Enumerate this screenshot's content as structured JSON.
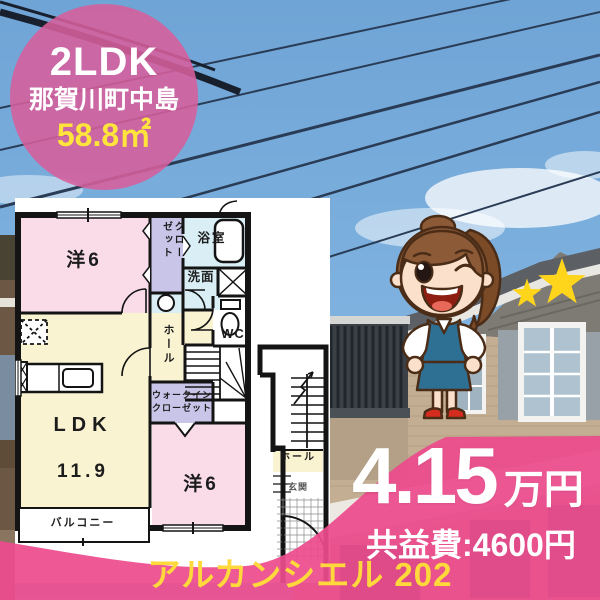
{
  "badge": {
    "layout_type": "2LDK",
    "location": "那賀川町中島",
    "area": "58.8㎡",
    "bg_color": "#D75F9C",
    "area_color": "#FFE53B"
  },
  "price": {
    "amount": "4.15",
    "unit": "万円",
    "fee": "共益費:4600円"
  },
  "property": {
    "name": "アルカンシエル 202"
  },
  "banner": {
    "bg_color": "#EC4B8D",
    "name_color": "#FFD93B"
  },
  "floor_plan": {
    "rooms": {
      "bedroom1": "洋6",
      "closet": "クローゼット",
      "bath": "浴室",
      "washroom": "洗面",
      "wc": "WC",
      "hall": "ホール",
      "ldk_name": "LDK",
      "ldk_size": "11.9",
      "wic": "ウォークイン\nクローゼット",
      "bedroom2": "洋6",
      "balcony": "バルコニー",
      "stair_hall": "ホール",
      "entrance": "玄関"
    },
    "colors": {
      "bedroom": "#F9DCE8",
      "ldk": "#FAF3D2",
      "closet_lavender": "#C9C5E9",
      "bath_blue": "#D9EEF5",
      "wall": "#141414"
    }
  },
  "photo": {
    "sky_color": "#74A8D8",
    "star_color": "#FFD51C"
  }
}
